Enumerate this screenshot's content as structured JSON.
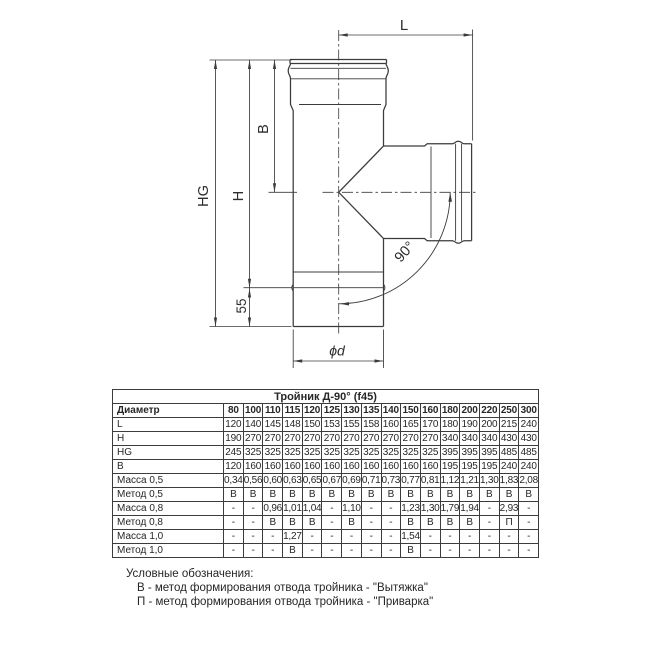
{
  "drawing": {
    "labels": {
      "L": "L",
      "B": "B",
      "H": "H",
      "HG": "HG",
      "dim55": "55",
      "diameter": "ϕd",
      "angle": "90°"
    }
  },
  "table": {
    "title": "Тройник Д-90° (f45)",
    "header_label": "Диаметр",
    "diameters": [
      "80",
      "100",
      "110",
      "115",
      "120",
      "125",
      "130",
      "135",
      "140",
      "150",
      "160",
      "180",
      "200",
      "220",
      "250",
      "300"
    ],
    "rows": [
      {
        "label": "L",
        "values": [
          "120",
          "140",
          "145",
          "148",
          "150",
          "153",
          "155",
          "158",
          "160",
          "165",
          "170",
          "180",
          "190",
          "200",
          "215",
          "240"
        ]
      },
      {
        "label": "H",
        "values": [
          "190",
          "270",
          "270",
          "270",
          "270",
          "270",
          "270",
          "270",
          "270",
          "270",
          "270",
          "340",
          "340",
          "340",
          "430",
          "430"
        ]
      },
      {
        "label": "HG",
        "values": [
          "245",
          "325",
          "325",
          "325",
          "325",
          "325",
          "325",
          "325",
          "325",
          "325",
          "325",
          "395",
          "395",
          "395",
          "485",
          "485"
        ]
      },
      {
        "label": "B",
        "values": [
          "120",
          "160",
          "160",
          "160",
          "160",
          "160",
          "160",
          "160",
          "160",
          "160",
          "160",
          "195",
          "195",
          "195",
          "240",
          "240"
        ]
      },
      {
        "label": "Масса 0,5",
        "values": [
          "0,34",
          "0,56",
          "0,60",
          "0,63",
          "0,65",
          "0,67",
          "0,69",
          "0,71",
          "0,73",
          "0,77",
          "0,81",
          "1,12",
          "1,21",
          "1,30",
          "1,83",
          "2,08"
        ]
      },
      {
        "label": "Метод 0,5",
        "values": [
          "В",
          "В",
          "В",
          "В",
          "В",
          "В",
          "В",
          "В",
          "В",
          "В",
          "В",
          "В",
          "В",
          "В",
          "В",
          "В"
        ]
      },
      {
        "label": "Масса 0,8",
        "values": [
          "-",
          "-",
          "0,96",
          "1,01",
          "1,04",
          "-",
          "1,10",
          "-",
          "-",
          "1,23",
          "1,30",
          "1,79",
          "1,94",
          "-",
          "2,93",
          "-"
        ]
      },
      {
        "label": "Метод 0,8",
        "values": [
          "-",
          "-",
          "В",
          "В",
          "В",
          "-",
          "В",
          "-",
          "-",
          "В",
          "В",
          "В",
          "В",
          "-",
          "П",
          "-"
        ]
      },
      {
        "label": "Масса 1,0",
        "values": [
          "-",
          "-",
          "-",
          "1,27",
          "-",
          "-",
          "-",
          "-",
          "-",
          "1,54",
          "-",
          "-",
          "-",
          "-",
          "-",
          "-"
        ]
      },
      {
        "label": "Метод 1,0",
        "values": [
          "-",
          "-",
          "-",
          "В",
          "-",
          "-",
          "-",
          "-",
          "-",
          "В",
          "-",
          "-",
          "-",
          "-",
          "-",
          "-"
        ]
      }
    ]
  },
  "legend": {
    "title": "Условные обозначения:",
    "items": [
      "В - метод формирования отвода тройника - \"Вытяжка\"",
      "П - метод формирования отвода тройника - \"Приварка\""
    ]
  },
  "colors": {
    "line": "#3b3b3b",
    "text": "#2a2a2a",
    "background": "#ffffff"
  }
}
